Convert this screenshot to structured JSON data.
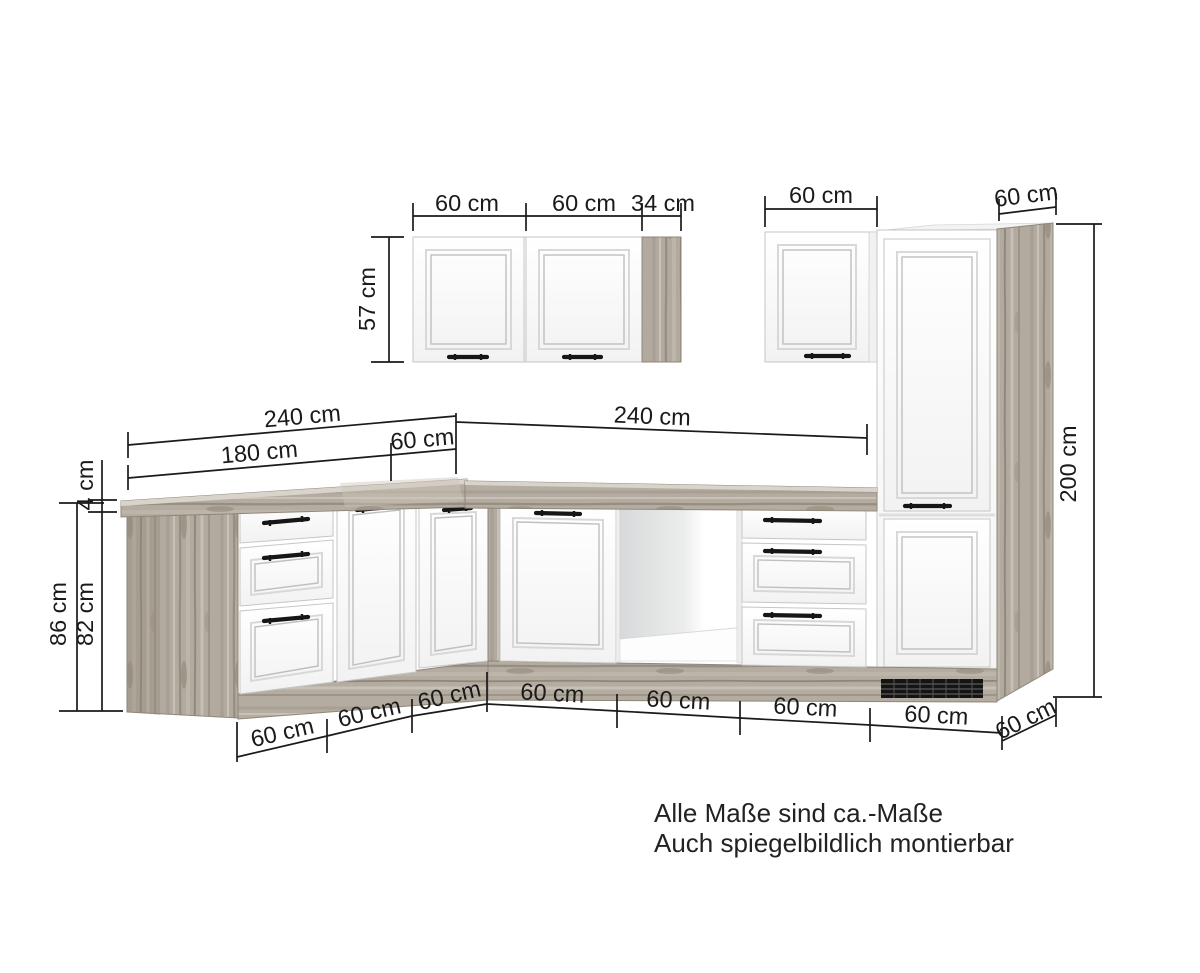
{
  "diagram": {
    "type": "kitchen-corner-unit-dimension-drawing",
    "colors": {
      "background": "#ffffff",
      "wood": "#b2aa9e",
      "wood_light": "#c9c3b9",
      "wood_dark": "#8e8678",
      "cabinet_front": "#fbfbfb",
      "dimension_line": "#1a1a1a",
      "vent": "#141414"
    },
    "dims": {
      "wall_left_door1": "60 cm",
      "wall_left_door2": "60 cm",
      "wall_left_panel": "34 cm",
      "wall_left_height": "57 cm",
      "wall_right_width": "60 cm",
      "tall_depth_top": "60 cm",
      "tall_height": "200 cm",
      "left_run_total": "240 cm",
      "right_run_total": "240 cm",
      "left_run_cabinets": "180 cm",
      "left_run_corner": "60 cm",
      "counter_thickness": "4 cm",
      "base_height_total": "86 cm",
      "base_height_body": "82 cm",
      "base_left_1": "60 cm",
      "base_left_2": "60 cm",
      "base_left_3": "60 cm",
      "base_right_1": "60 cm",
      "base_right_2": "60 cm",
      "base_right_3": "60 cm",
      "base_right_4": "60 cm",
      "tall_depth_bottom": "60 cm"
    },
    "notes": {
      "line1": "Alle Maße sind ca.-Maße",
      "line2": "Auch spiegelbildlich montierbar"
    }
  }
}
